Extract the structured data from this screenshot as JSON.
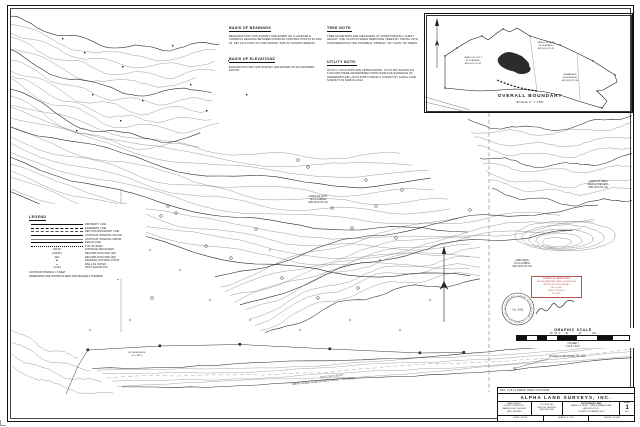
{
  "notes": {
    "bearings": {
      "title": "BASIS OF BEARINGS",
      "body": "BEARINGS FOR THIS SURVEY ARE BASED ON A HANDHELD COMPASS READING BETWEEN RANDOM CONTROL POINTS #1 AND #2, SET AS A PART OF THIS SURVEY AND AS SHOWN HEREON."
    },
    "elevations": {
      "title": "BASIS OF ELEVATIONS",
      "body": "ELEVATIONS FOR THIS SURVEY ARE BASED ON AN ASSUMED DATUM."
    },
    "tree": {
      "title": "TREE NOTE:",
      "body": "TREE DIAMETERS ARE MEASURED AT APPROXIMATELY CHEST HEIGHT. USE CAUTION WHEN REMOVING TREES BY TAKING INTO CONSIDERATION THE POSSIBLE \"SPREAD\" OR \"LEAN\" OF TREES."
    },
    "utility": {
      "title": "UTILITY NOTE:",
      "body": "UTILITY LOCATIONS ARE APPROXIMATE. UTILITIES SHOWN ON THIS MAP WERE DETERMINED FROM SURFACE EVIDENCE OF UNDERGROUND LOCATIONS DURING A SURVEY BY ALPHA LAND SURVEYS IN MARCH 2012."
    }
  },
  "inset": {
    "title": "OVERALL BOUNDARY",
    "scale": "SCALE 1\" = 150'",
    "parcels": [
      {
        "l1": "LANDS OF GOTT",
        "l2": "30.31 ACRES±",
        "l3": "APN 076-271-31"
      },
      {
        "l1": "LANDS OF SESS",
        "l2": "24.75 ACRES±",
        "l3": "APN 076-271-32"
      },
      {
        "l1": "REMAINDER",
        "l2": "18.20 ACRES±",
        "l3": "APN 076-271-33"
      }
    ]
  },
  "legend": {
    "title": "LEGEND",
    "items": [
      {
        "label": "PROPERTY LINE",
        "sample": ""
      },
      {
        "label": "EASEMENT LINE",
        "sample": ""
      },
      {
        "label": "SECTION BOUNDARY LINE",
        "sample": ""
      },
      {
        "label": "CONTOUR INTERVAL MAJOR",
        "sample": ""
      },
      {
        "label": "CONTOUR INTERVAL MINOR",
        "sample": ""
      },
      {
        "label": "FENCE LINE",
        "sample": ""
      },
      {
        "label": "TOP OF BANK",
        "sample": ""
      },
      {
        "label": "DISTANCE MEASURED",
        "sample": "100.00'"
      },
      {
        "label": "RECORD DATA PER (R1)",
        "sample": "(100.00')"
      },
      {
        "label": "RECORD DATA PER (R2)",
        "sample": "(R2)"
      },
      {
        "label": "RANDOM CONTROL POINT",
        "sample": "■"
      },
      {
        "label": "WELL AS NOTED",
        "sample": "●"
      },
      {
        "label": "SPOT ELEVATION",
        "sample": "× 123.4"
      }
    ],
    "footnote1": "CONTOUR INTERVAL = 5 FEET",
    "footnote2": "DIMENSIONS ARE SHOWN IN FEET AND DECIMALS THEREOF"
  },
  "map_labels": {
    "parcel_center": {
      "l1": "LANDS OF GOTT",
      "l2": "30.31 ACRES±",
      "l3": "APN (076-271-31)"
    },
    "parcel_right": {
      "l1": "LANDS OF SESS",
      "l2": "(DESIGN REVIEW)",
      "l3": "APN (076-271-32)"
    },
    "parcel_mid": {
      "l1": "ANNA SESS",
      "l2": "10.01 ACRES±",
      "l3": "APN (076-271-32)"
    },
    "residence": {
      "l1": "EX. RESIDENCE",
      "l2": "FF = 362.4"
    },
    "road": "SMITH GRADE ROAD  (COUNTY ROAD — 40' WIDE)",
    "bearing": "N 87°12'44\" E   325.07'",
    "found_note": "FOUND 1/2\" IRON PIPE, NO TAG"
  },
  "stamp": {
    "color": "#b3524e",
    "lines": [
      "COUNTY OF SANTA CRUZ",
      "ENVIRONMENTAL HEALTH SERVICES",
      "APPROVED FOR PERMIT",
      "No. 1-2345",
      "DATE: 3/15/2012",
      "BY: R.W."
    ]
  },
  "seal": {
    "ring": "LICENSED LAND SURVEYOR • STATE OF CALIFORNIA •",
    "center": "No. 5411"
  },
  "graphic_scale": {
    "title": "GRAPHIC SCALE",
    "ticks": "30   15   0        30                 60                 120",
    "in_feet": "( IN FEET )",
    "equiv": "1 inch = 30 ft."
  },
  "title_block": {
    "revision": "REV:  3-28-12  ADDED TREE LOCATIONS",
    "company": "ALPHA LAND SURVEYS, INC.",
    "office1": {
      "l1": "MAIN OFFICE",
      "l2": "265-B POTRERO ST.",
      "l3": "SANTA CRUZ, CA 95060",
      "l4": "(831) 426-6565"
    },
    "office2": {
      "l1": "P.O. BOX 100",
      "l2": "FELTON, CA 95018",
      "l3": "(831) 335-5700"
    },
    "project": {
      "l1": "TOPOGRAPHIC MAP",
      "l2": "LANDS OF SESS — SMITH GRADE ROAD",
      "l3": "APN 076-271-32",
      "l4": "COUNTY OF SANTA CRUZ"
    },
    "sheet": {
      "label": "SHEET",
      "number": "1",
      "of": "OF 1"
    },
    "date": "DATE: 3-2012",
    "scale": "SCALE: 1\" = 30'",
    "job": "JOB NO. 12-034"
  }
}
